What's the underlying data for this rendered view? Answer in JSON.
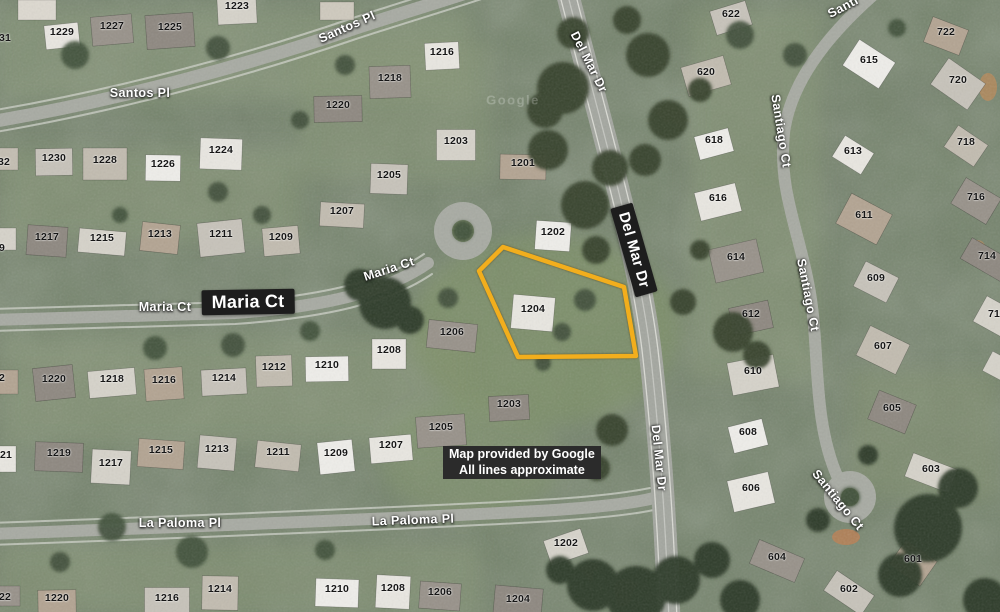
{
  "map": {
    "watermark": "Google",
    "attribution": {
      "line1": "Map provided by Google",
      "line2": "All lines approximate"
    },
    "colors": {
      "parcel_outline": "#F2AE1D",
      "label_box_bg": "#1d1d1d",
      "street_label_text": "#ffffff",
      "house_number_text": "#161616",
      "attribution_bg": "#2b2b2b"
    },
    "parcel": {
      "number": "1204",
      "outline_points": [
        [
          503,
          247
        ],
        [
          624,
          287
        ],
        [
          636,
          356
        ],
        [
          518,
          357
        ],
        [
          479,
          271
        ]
      ]
    },
    "street_labels": [
      {
        "text": "Santos Pl",
        "x": 140,
        "y": 93,
        "rot": 0,
        "style": "plain"
      },
      {
        "text": "Santos Pl",
        "x": 347,
        "y": 27,
        "rot": -24,
        "style": "plain"
      },
      {
        "text": "Del Mar Dr",
        "x": 589,
        "y": 62,
        "rot": 63,
        "style": "plain"
      },
      {
        "text": "Del Mar Dr",
        "x": 634,
        "y": 250,
        "rot": 74,
        "style": "boxed"
      },
      {
        "text": "Del Mar Dr",
        "x": 659,
        "y": 458,
        "rot": 84,
        "style": "plain"
      },
      {
        "text": "Santi",
        "x": 843,
        "y": 7,
        "rot": -28,
        "style": "plain"
      },
      {
        "text": "Santiago Ct",
        "x": 781,
        "y": 131,
        "rot": 81,
        "style": "plain"
      },
      {
        "text": "Santiago Ct",
        "x": 808,
        "y": 295,
        "rot": 79,
        "style": "plain"
      },
      {
        "text": "Santiago Ct",
        "x": 838,
        "y": 500,
        "rot": 51,
        "style": "plain"
      },
      {
        "text": "Maria Ct",
        "x": 165,
        "y": 307,
        "rot": 0,
        "style": "plain"
      },
      {
        "text": "Maria Ct",
        "x": 248,
        "y": 302,
        "rot": -1,
        "style": "boxed-large"
      },
      {
        "text": "Maria Ct",
        "x": 389,
        "y": 269,
        "rot": -18,
        "style": "plain"
      },
      {
        "text": "La Paloma Pl",
        "x": 180,
        "y": 523,
        "rot": 0,
        "style": "plain"
      },
      {
        "text": "La Paloma Pl",
        "x": 413,
        "y": 520,
        "rot": -2,
        "style": "plain"
      }
    ],
    "house_numbers": [
      {
        "n": "1229",
        "x": 62,
        "y": 32
      },
      {
        "n": "1227",
        "x": 112,
        "y": 26
      },
      {
        "n": "1225",
        "x": 170,
        "y": 27
      },
      {
        "n": "1223",
        "x": 237,
        "y": 6
      },
      {
        "n": "31",
        "x": 5,
        "y": 38
      },
      {
        "n": "1230",
        "x": 54,
        "y": 158
      },
      {
        "n": "1228",
        "x": 105,
        "y": 160
      },
      {
        "n": "1226",
        "x": 163,
        "y": 164
      },
      {
        "n": "1224",
        "x": 221,
        "y": 150
      },
      {
        "n": "32",
        "x": 4,
        "y": 162
      },
      {
        "n": "1217",
        "x": 47,
        "y": 237
      },
      {
        "n": "1215",
        "x": 102,
        "y": 238
      },
      {
        "n": "1213",
        "x": 160,
        "y": 234
      },
      {
        "n": "1211",
        "x": 221,
        "y": 234
      },
      {
        "n": "1209",
        "x": 281,
        "y": 237
      },
      {
        "n": "9",
        "x": 2,
        "y": 248
      },
      {
        "n": "1216",
        "x": 442,
        "y": 52
      },
      {
        "n": "1218",
        "x": 390,
        "y": 78
      },
      {
        "n": "1220",
        "x": 338,
        "y": 105
      },
      {
        "n": "1203",
        "x": 456,
        "y": 141
      },
      {
        "n": "1201",
        "x": 523,
        "y": 163
      },
      {
        "n": "1205",
        "x": 389,
        "y": 175
      },
      {
        "n": "1207",
        "x": 342,
        "y": 211
      },
      {
        "n": "1202",
        "x": 553,
        "y": 232
      },
      {
        "n": "1204",
        "x": 533,
        "y": 309
      },
      {
        "n": "1206",
        "x": 452,
        "y": 332
      },
      {
        "n": "1220",
        "x": 54,
        "y": 379
      },
      {
        "n": "1218",
        "x": 112,
        "y": 379
      },
      {
        "n": "1216",
        "x": 164,
        "y": 380
      },
      {
        "n": "1214",
        "x": 224,
        "y": 378
      },
      {
        "n": "1212",
        "x": 274,
        "y": 367
      },
      {
        "n": "1210",
        "x": 327,
        "y": 365
      },
      {
        "n": "1208",
        "x": 389,
        "y": 350
      },
      {
        "n": "2",
        "x": 2,
        "y": 378
      },
      {
        "n": "1219",
        "x": 59,
        "y": 453
      },
      {
        "n": "1217",
        "x": 111,
        "y": 463
      },
      {
        "n": "1215",
        "x": 161,
        "y": 450
      },
      {
        "n": "1213",
        "x": 217,
        "y": 449
      },
      {
        "n": "1211",
        "x": 278,
        "y": 452
      },
      {
        "n": "1209",
        "x": 336,
        "y": 453
      },
      {
        "n": "1207",
        "x": 391,
        "y": 445
      },
      {
        "n": "1205",
        "x": 441,
        "y": 427
      },
      {
        "n": "1203",
        "x": 509,
        "y": 404
      },
      {
        "n": "21",
        "x": 6,
        "y": 455
      },
      {
        "n": "1220",
        "x": 57,
        "y": 598
      },
      {
        "n": "1216",
        "x": 167,
        "y": 598
      },
      {
        "n": "1214",
        "x": 220,
        "y": 589
      },
      {
        "n": "1210",
        "x": 337,
        "y": 589
      },
      {
        "n": "1208",
        "x": 393,
        "y": 588
      },
      {
        "n": "1206",
        "x": 440,
        "y": 592
      },
      {
        "n": "1204",
        "x": 518,
        "y": 599
      },
      {
        "n": "1202",
        "x": 566,
        "y": 543
      },
      {
        "n": "22",
        "x": 5,
        "y": 597
      },
      {
        "n": "622",
        "x": 731,
        "y": 14
      },
      {
        "n": "620",
        "x": 706,
        "y": 72
      },
      {
        "n": "618",
        "x": 714,
        "y": 140
      },
      {
        "n": "616",
        "x": 718,
        "y": 198
      },
      {
        "n": "614",
        "x": 736,
        "y": 257
      },
      {
        "n": "612",
        "x": 751,
        "y": 314
      },
      {
        "n": "610",
        "x": 753,
        "y": 371
      },
      {
        "n": "722",
        "x": 946,
        "y": 32
      },
      {
        "n": "720",
        "x": 958,
        "y": 80
      },
      {
        "n": "718",
        "x": 966,
        "y": 142
      },
      {
        "n": "615",
        "x": 869,
        "y": 60
      },
      {
        "n": "613",
        "x": 853,
        "y": 151
      },
      {
        "n": "716",
        "x": 976,
        "y": 197
      },
      {
        "n": "714",
        "x": 987,
        "y": 256
      },
      {
        "n": "712",
        "x": 997,
        "y": 314
      },
      {
        "n": "611",
        "x": 864,
        "y": 215
      },
      {
        "n": "609",
        "x": 876,
        "y": 278
      },
      {
        "n": "607",
        "x": 883,
        "y": 346
      },
      {
        "n": "608",
        "x": 748,
        "y": 432
      },
      {
        "n": "606",
        "x": 751,
        "y": 488
      },
      {
        "n": "604",
        "x": 777,
        "y": 557
      },
      {
        "n": "605",
        "x": 892,
        "y": 408
      },
      {
        "n": "603",
        "x": 931,
        "y": 469
      },
      {
        "n": "601",
        "x": 913,
        "y": 559
      },
      {
        "n": "602",
        "x": 849,
        "y": 589
      }
    ]
  }
}
